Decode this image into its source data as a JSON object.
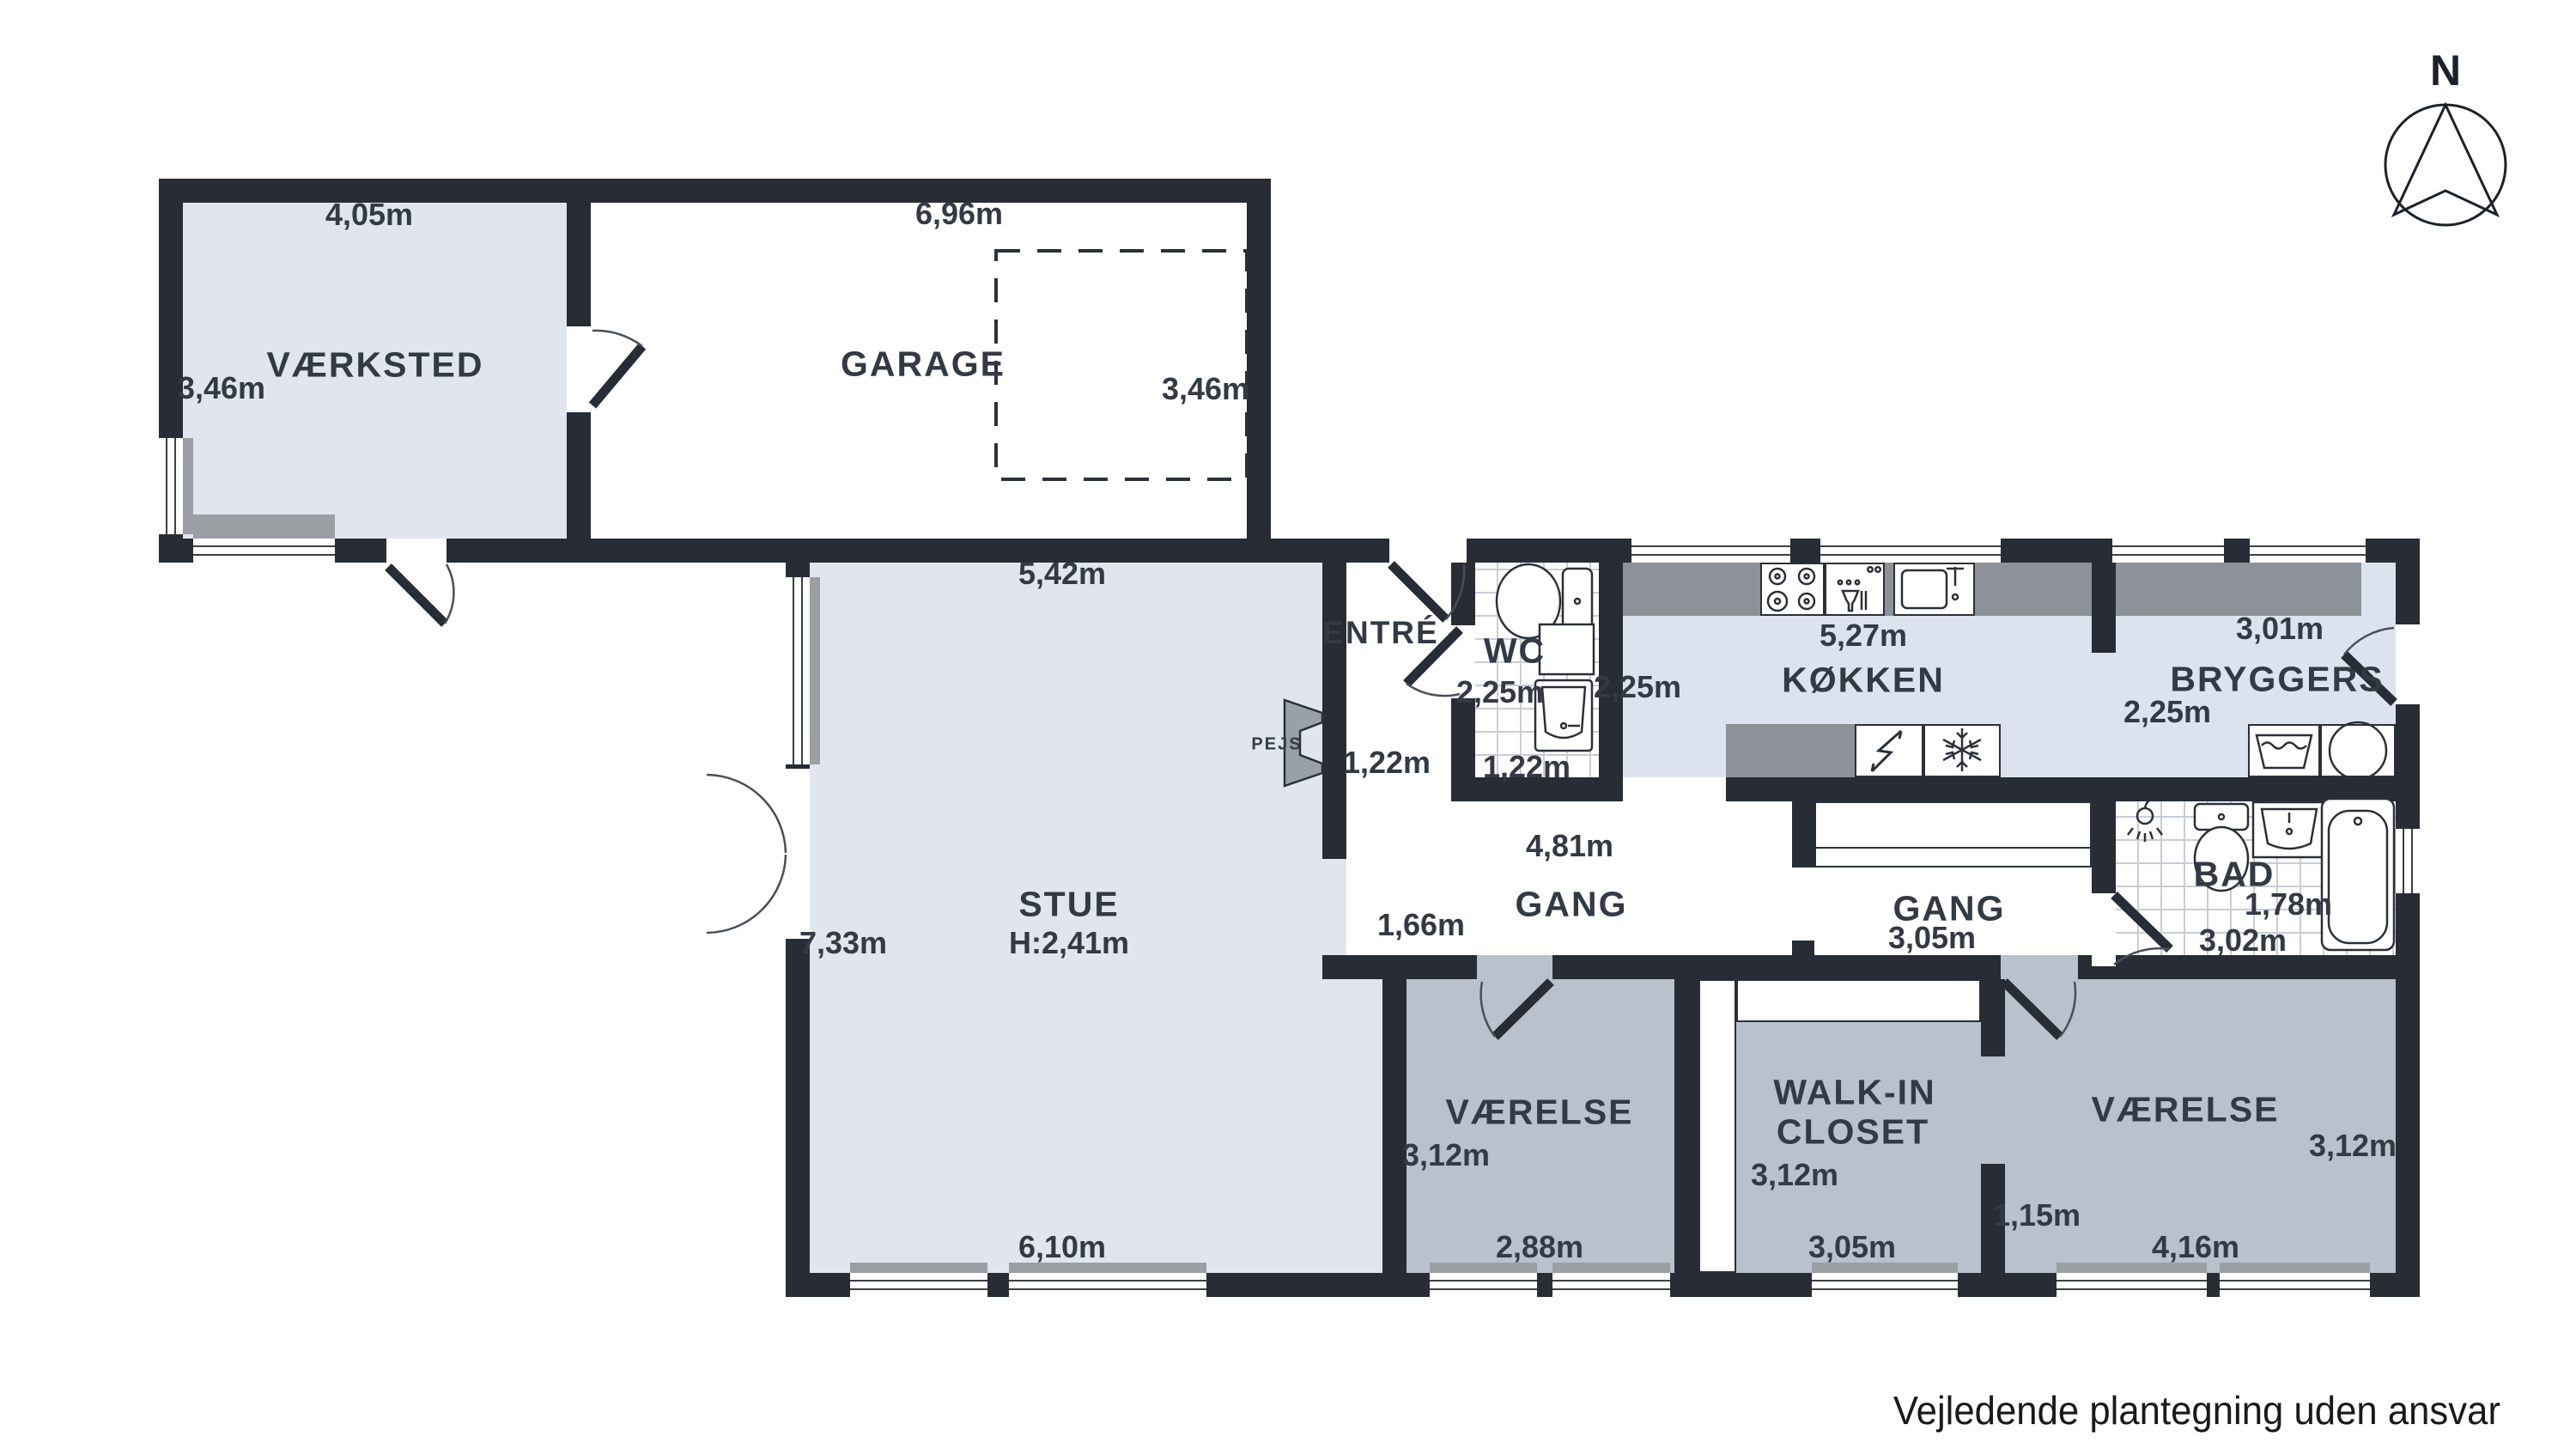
{
  "meta": {
    "footer": "Vejledende plantegning uden ansvar",
    "compass_label": "N"
  },
  "colors": {
    "wall": "#272c35",
    "room_light": "#e0e5ee",
    "room_gray": "#b9c1cd",
    "counter": "#8d9298",
    "label_text": "#343a44"
  },
  "rooms": {
    "vaerksted": {
      "name": "VÆRKSTED",
      "width": "4,05m",
      "depth": "3,46m"
    },
    "garage": {
      "name": "GARAGE",
      "width": "6,96m",
      "depth": "3,46m"
    },
    "stue": {
      "name": "STUE",
      "ceiling": "H:2,41m",
      "width_top": "5,42m",
      "depth": "7,33m",
      "width_bottom": "6,10m"
    },
    "entre": {
      "name": "ENTRÉ",
      "width": "1,22m"
    },
    "wc": {
      "name": "WC",
      "depth": "2,25m",
      "width": "1,22m"
    },
    "koekken": {
      "name": "KØKKEN",
      "width": "5,27m",
      "depth": "2,25m"
    },
    "bryggers": {
      "name": "BRYGGERS",
      "width": "3,01m",
      "depth": "2,25m"
    },
    "gang1": {
      "name": "GANG",
      "width": "4,81m",
      "opening": "1,66m"
    },
    "gang2": {
      "name": "GANG",
      "width": "3,05m"
    },
    "bad": {
      "name": "BAD",
      "depth": "1,78m",
      "width": "3,02m"
    },
    "vaerelse1": {
      "name": "VÆRELSE",
      "depth": "3,12m",
      "width": "2,88m"
    },
    "walkin": {
      "line1": "WALK-IN",
      "line2": "CLOSET",
      "depth": "3,12m",
      "width": "3,05m",
      "opening": "1,15m"
    },
    "vaerelse2": {
      "name": "VÆRELSE",
      "depth": "3,12m",
      "width": "4,16m"
    },
    "pejs": {
      "label": "PEJS"
    }
  },
  "icons": {
    "compass": "north-arrow",
    "stove": "stove-icon",
    "dishwasher": "dishwasher-icon",
    "kitchen_sink": "sink-icon",
    "fridge": "lightning-icon",
    "freezer": "snowflake-icon",
    "laundry_tub": "laundry-tub-icon",
    "washer": "washing-machine-icon",
    "toilet": "toilet-icon",
    "bathtub": "bathtub-icon",
    "shower": "shower-head-icon"
  }
}
